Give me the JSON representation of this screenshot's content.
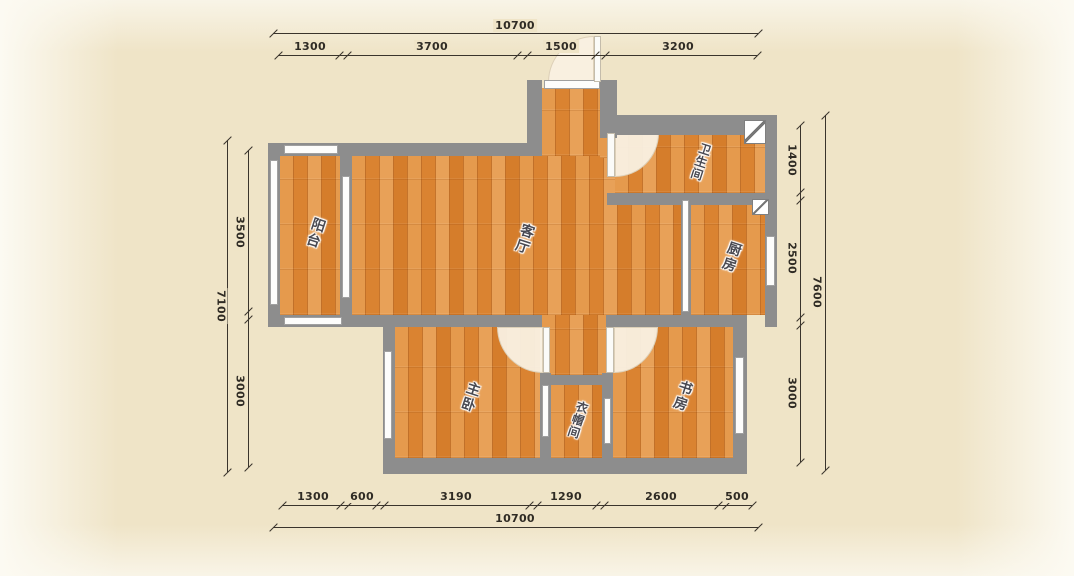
{
  "title": "apartment-floor-plan",
  "rooms": {
    "balcony": {
      "label": "阳台"
    },
    "living": {
      "label": "客厅"
    },
    "bathroom": {
      "label": "卫生间"
    },
    "kitchen": {
      "label": "厨房"
    },
    "bedroom": {
      "label": "主卧"
    },
    "cloakroom": {
      "label": "衣帽间"
    },
    "study": {
      "label": "书房"
    }
  },
  "dims": {
    "top": {
      "total": "10700",
      "segments": [
        "1300",
        "3700",
        "1500",
        "3200"
      ]
    },
    "bottom": {
      "total": "10700",
      "segments": [
        "1300",
        "600",
        "3190",
        "1290",
        "2600",
        "500"
      ]
    },
    "left": {
      "total": "7100",
      "segments": [
        "3500",
        "3000"
      ]
    },
    "right": {
      "total": "7600",
      "segments": [
        "1400",
        "2500",
        "3000"
      ]
    }
  },
  "colors": {
    "background": "#efe4c7",
    "wall": "#8d8d8d",
    "floor": "#dd8a3a",
    "floor_light": "#e8a158",
    "dimension": "#3a342c",
    "label_text": "#4a4a52",
    "window": "#ffffff",
    "door_arc": "#f9f0e2"
  }
}
